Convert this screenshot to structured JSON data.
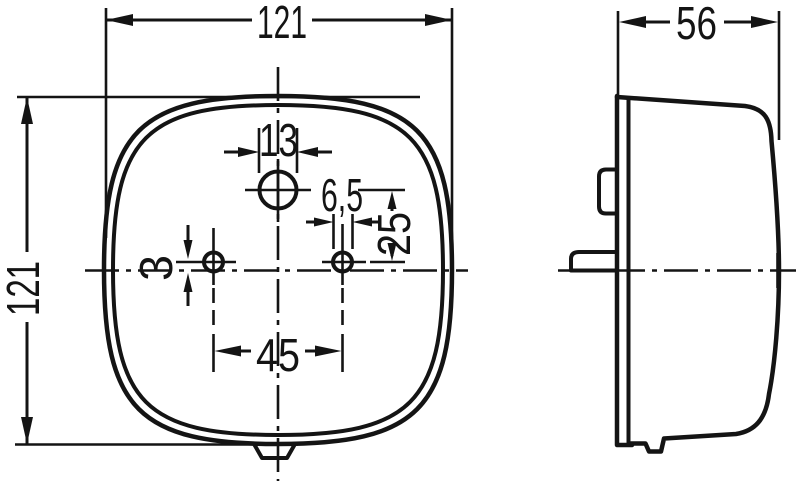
{
  "drawing": {
    "type": "technical-dimension-drawing",
    "views": {
      "front": {
        "dim_width": "121",
        "dim_height": "121",
        "dim_top_hole_dia": "13",
        "dim_small_hole_dia": "6,5",
        "dim_vertical_hole_spacing": "25",
        "dim_hole_offset_from_centerline": "3",
        "dim_hole_spacing": "45"
      },
      "side": {
        "dim_depth": "56"
      }
    },
    "colors": {
      "line": "#141414",
      "background": "#ffffff"
    }
  }
}
